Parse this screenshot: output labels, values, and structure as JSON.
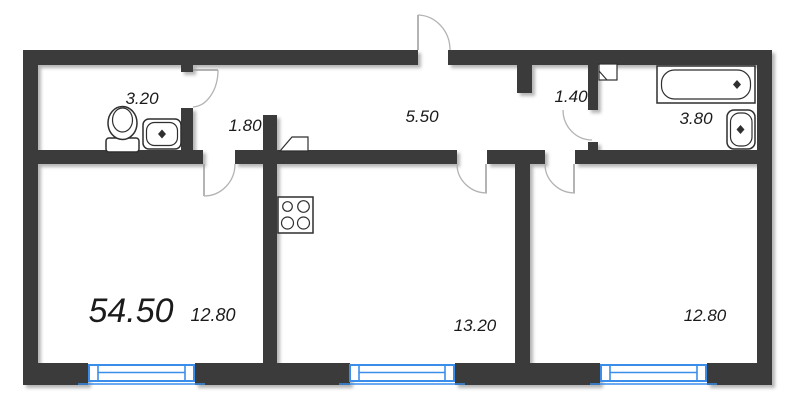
{
  "plan": {
    "title": "apartment-floor-plan",
    "total_area": "54.50",
    "labels": {
      "bathroom_area": "3.20",
      "corridor_width": "1.80",
      "hallway_area": "5.50",
      "vestibule_area": "1.40",
      "bathroom2_area": "3.80",
      "living_room_area": "12.80",
      "kitchen_area": "13.20",
      "bedroom_area": "12.80"
    },
    "rooms": [
      {
        "name": "bathroom",
        "area": "3.20"
      },
      {
        "name": "corridor",
        "area": "1.80"
      },
      {
        "name": "hallway",
        "area": "5.50"
      },
      {
        "name": "vestibule",
        "area": "1.40"
      },
      {
        "name": "bathroom-2",
        "area": "3.80"
      },
      {
        "name": "living-room",
        "area": "12.80"
      },
      {
        "name": "kitchen",
        "area": "13.20"
      },
      {
        "name": "bedroom",
        "area": "12.80"
      }
    ],
    "fixtures": [
      "toilet-icon",
      "sink-icon",
      "bathtub-icon",
      "sink-icon",
      "stove-icon",
      "cabinet-icon",
      "panel-icon"
    ],
    "colors": {
      "wall": "#3b3b3b",
      "window": "#3b8dea",
      "door_arc": "#b3b3b3",
      "fixture_stroke": "#2f2f2f",
      "text": "#1b1b1b",
      "background": "#ffffff"
    }
  }
}
